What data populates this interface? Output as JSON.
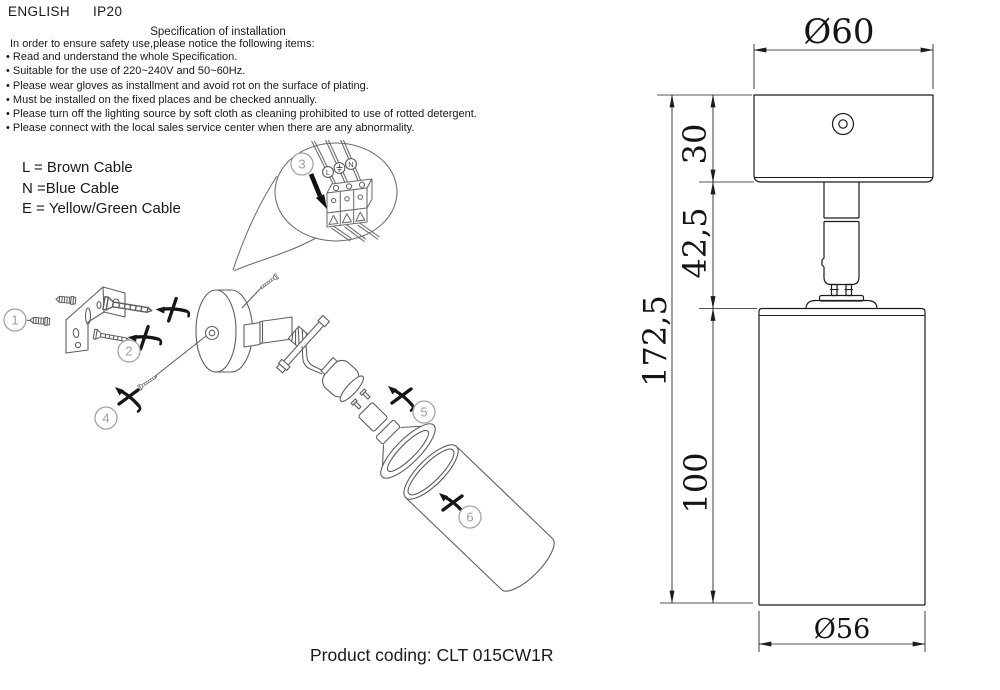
{
  "header": {
    "language": "ENGLISH",
    "ip_rating": "IP20"
  },
  "spec": {
    "title": "Specification of installation",
    "intro": "In order to ensure safety use,please notice the following items:",
    "items": [
      "• Read and understand the whole Specification.",
      "• Suitable for the use of 220~240V and 50~60Hz.",
      "• Please wear gloves as installment and avoid rot on the surface of plating.",
      "• Must be installed on the fixed places and be checked annually.",
      "• Please turn off the lighting source by soft cloth as cleaning prohibited to use of rotted detergent.",
      "• Please connect with the local sales service center when there are any abnormality."
    ]
  },
  "cable_legend": {
    "live": "L = Brown Cable",
    "neutral": "N =Blue Cable",
    "earth": "E = Yellow/Green Cable"
  },
  "wiring_callout": {
    "step_number": "3",
    "terminal_live": "L",
    "terminal_neutral": "N",
    "earth_icon": "earth-ground-symbol"
  },
  "assembly_steps": {
    "anchors": "1",
    "screws": "2",
    "canopy_screw": "4",
    "bulb": "5",
    "shade": "6"
  },
  "dimension_drawing": {
    "canopy_diameter": "Ø60",
    "canopy_height": "30",
    "stem_height": "42,5",
    "total_height": "172,5",
    "body_height": "100",
    "body_diameter": "Ø56"
  },
  "footer": {
    "product_coding": "Product coding: CLT 015CW1R"
  },
  "colors": {
    "drawing_line": "#5f5f5f",
    "dimension_line": "#1c1c1c",
    "badge_gray": "#9e9e9e",
    "text": "#1a1a1a"
  }
}
